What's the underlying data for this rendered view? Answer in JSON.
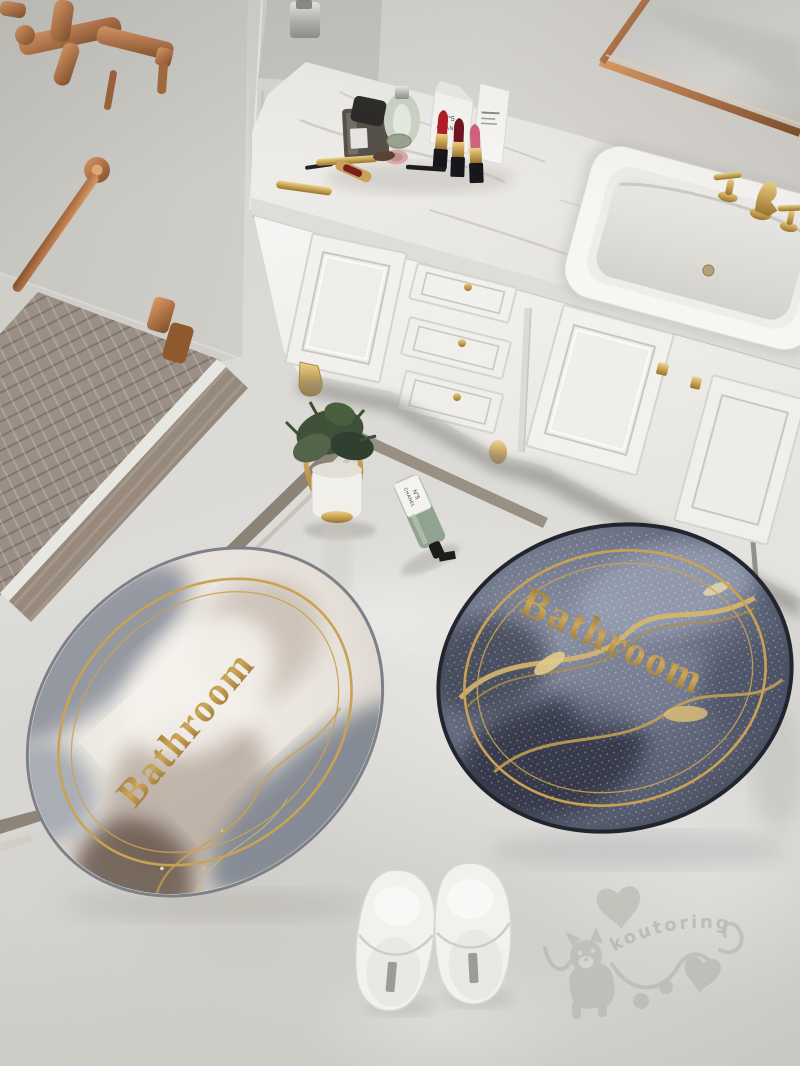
{
  "mats": {
    "light": {
      "label": "Bathroom",
      "text_color": "#b3863f",
      "base_color": "#ece8e2",
      "patch_color": "#b6a89d",
      "ring_color": "#c9a254"
    },
    "dark": {
      "label": "Bathroom",
      "text_color": "#c49a4e",
      "base_color": "#6e7487",
      "shadow_color": "#2f3440",
      "ring_color": "#c9a254"
    }
  },
  "watermark": {
    "text": "koutoring",
    "color": "#b3b1aa",
    "icons": [
      "dog-icon",
      "heart-icon",
      "paw-dots-icon",
      "squiggle-icon"
    ]
  },
  "cosmetics": {
    "box_label": {
      "line1": "N°5",
      "line2": "CHANEL"
    },
    "soap_label": {
      "line1": "N°5",
      "line2": "CHANEL"
    },
    "lipstick_colors": [
      "#b01c24",
      "#6e1420",
      "#d2607c"
    ]
  },
  "palette": {
    "floor": "#d8d7d3",
    "wall": "#cfcdc8",
    "mosaic_tile": "#9a8f84",
    "cabinet": "#f2f1ee",
    "counter": "#edebe7",
    "gold_hardware": "#c9a254",
    "copper_fixture": "#b5764a",
    "slipper": "#f2f1ee",
    "greenery": "#3f5239",
    "soap_glass": "#8fa390",
    "sink": "#f7f6f3"
  }
}
